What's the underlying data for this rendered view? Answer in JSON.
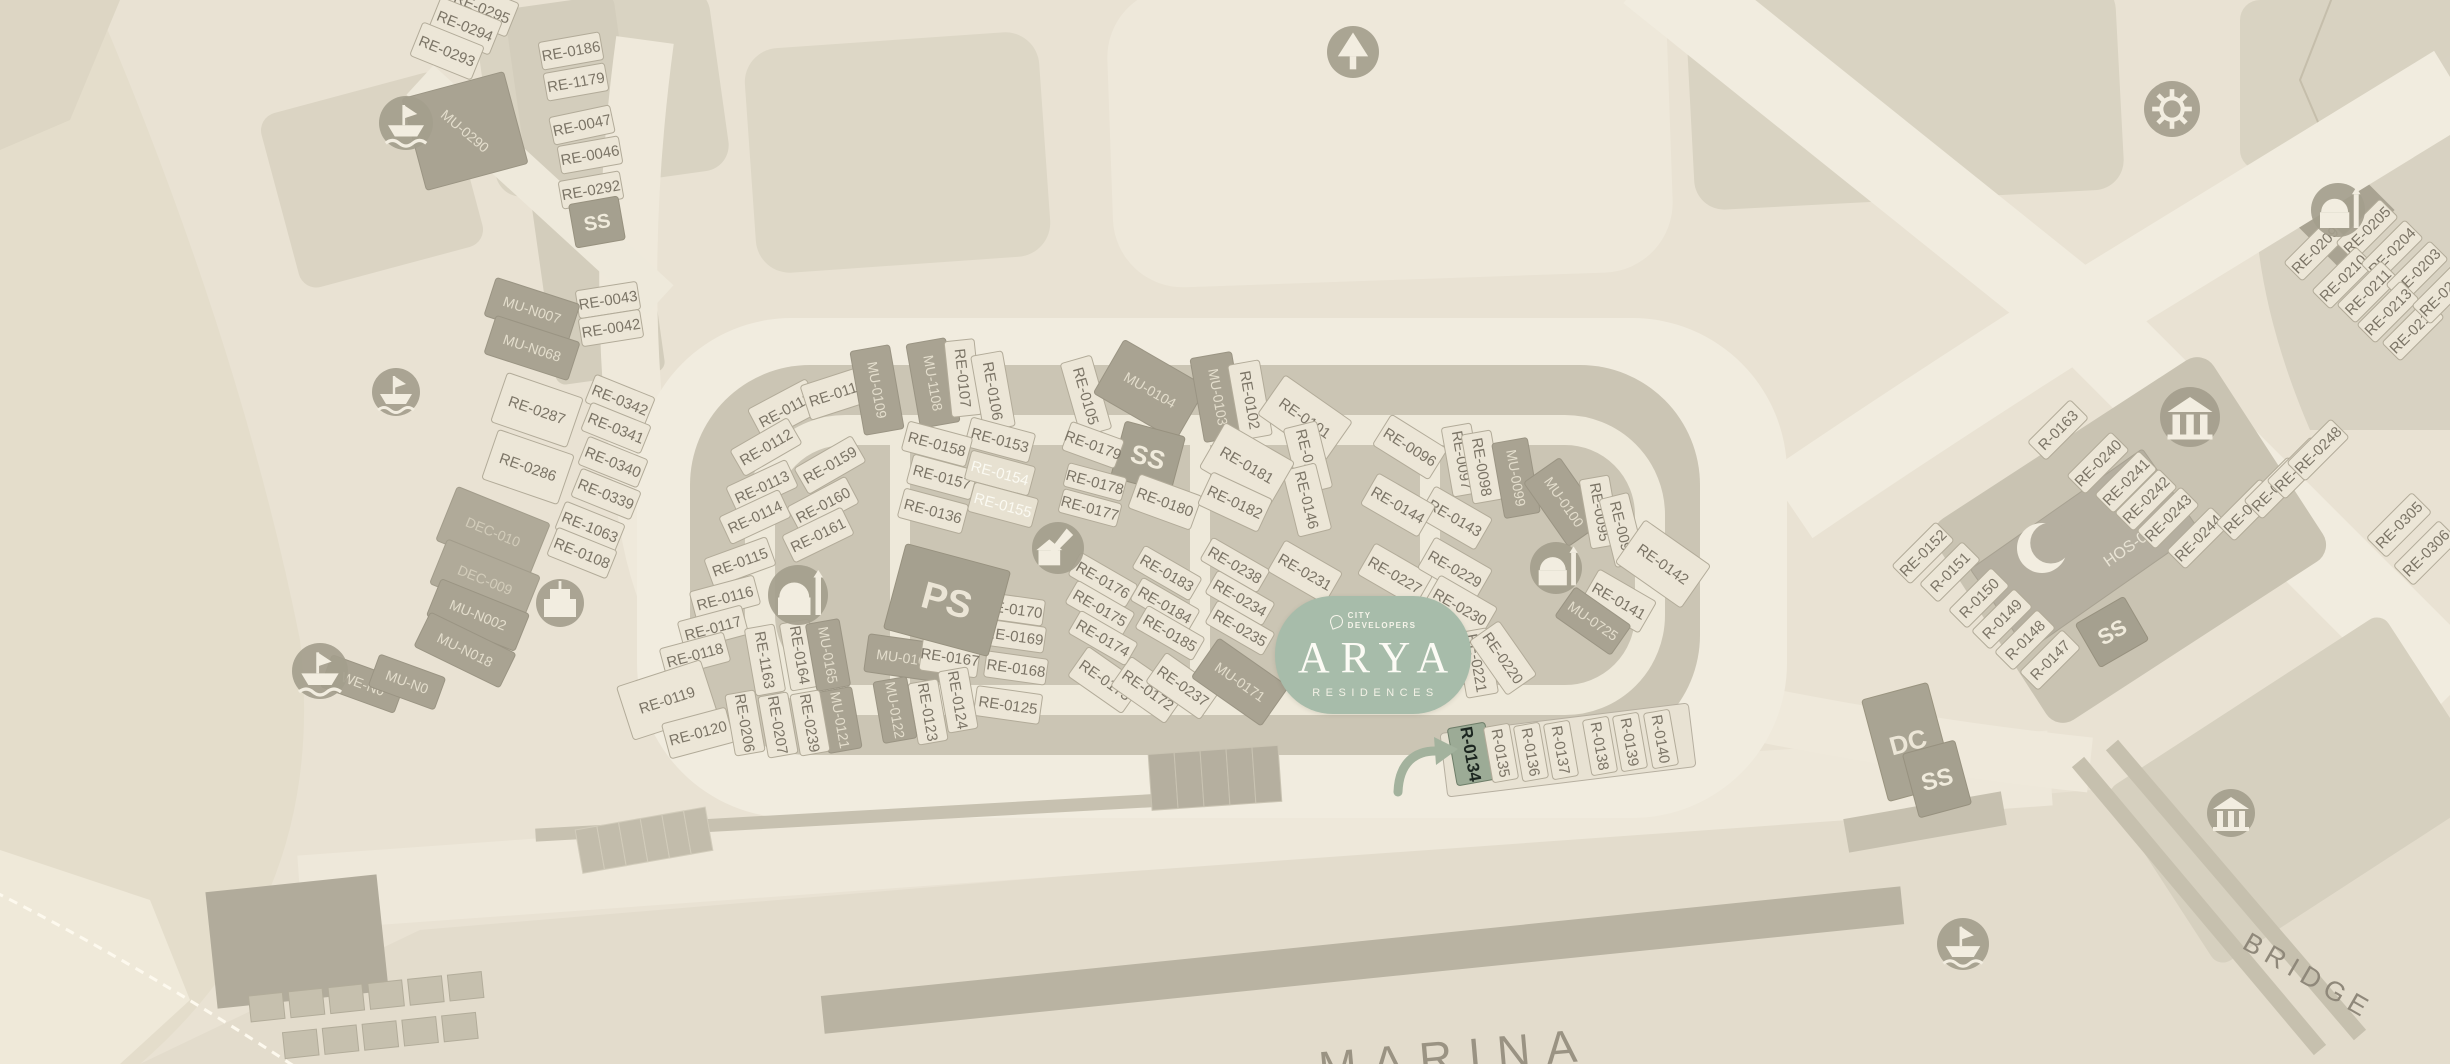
{
  "badge": {
    "developer_line1": "CITY",
    "developer_line2": "DEVELOPERS",
    "name": "ARYA",
    "subtitle": "RESIDENCES"
  },
  "highlighted_plot": "R-0134",
  "palette": {
    "bg": "#e9e2d3",
    "coast": "#e4ddcb",
    "block": "#d9d3c2",
    "cluster_base": "#cbc5b4",
    "road": "#f1ecdf",
    "plot": "#ece6d7",
    "plot_stroke": "#b2ab99",
    "label": "#7b7466",
    "dark_plot": "#a9a392",
    "dark_label": "#e4decd",
    "badge_green": "#a7bcaa",
    "highlight_fill": "#9cab96",
    "highlight_text": "#1c2620",
    "arrow": "#a3b29d",
    "icon_bg": "#a49e8d",
    "icon_glyph": "#f2ede0",
    "quay": "#b9b3a2",
    "marina_text": "#9a9383",
    "bridge_text": "#8f887a"
  },
  "map_texts": [
    {
      "id": "marina-label",
      "label": "MARINA",
      "x": 1457,
      "y": 1072,
      "rot": -5,
      "size": 46,
      "ls": 16,
      "color": "#9a9383"
    },
    {
      "id": "bridge-label",
      "label": "BRIDGE",
      "x": 2304,
      "y": 984,
      "rot": 30,
      "size": 27,
      "ls": 7,
      "color": "#8f887a"
    }
  ],
  "plots": [
    {
      "l": "RE-0295",
      "x": 482,
      "y": 8,
      "r": 22
    },
    {
      "l": "RE-0294",
      "x": 465,
      "y": 26,
      "r": 22
    },
    {
      "l": "RE-0293",
      "x": 447,
      "y": 51,
      "r": 22
    },
    {
      "l": "RE-0186",
      "x": 571,
      "y": 51,
      "r": -10,
      "w": 62,
      "h": 28
    },
    {
      "l": "RE-1179",
      "x": 576,
      "y": 82,
      "r": -10,
      "w": 62,
      "h": 28
    },
    {
      "l": "RE-0047",
      "x": 582,
      "y": 125,
      "r": -12,
      "w": 62,
      "h": 28
    },
    {
      "l": "RE-0046",
      "x": 590,
      "y": 155,
      "r": -10,
      "w": 62,
      "h": 28
    },
    {
      "l": "RE-0292",
      "x": 591,
      "y": 190,
      "r": -10,
      "w": 62,
      "h": 28
    },
    {
      "l": "SS",
      "x": 597,
      "y": 222,
      "r": -10,
      "t": "ss",
      "w": 50,
      "h": 44,
      "fs": 20
    },
    {
      "l": "RE-0043",
      "x": 608,
      "y": 300,
      "r": -9,
      "w": 62,
      "h": 28
    },
    {
      "l": "RE-0042",
      "x": 611,
      "y": 328,
      "r": -9,
      "w": 62,
      "h": 28
    },
    {
      "l": "MU-0290",
      "x": 465,
      "y": 131,
      "r": -15,
      "tr": 40,
      "t": "mu",
      "w": 105,
      "h": 95
    },
    {
      "l": "MU-N007",
      "x": 532,
      "y": 310,
      "r": 18,
      "t": "mu",
      "w": 88,
      "h": 40
    },
    {
      "l": "MU-N068",
      "x": 532,
      "y": 348,
      "r": 18,
      "t": "mu",
      "w": 88,
      "h": 40
    },
    {
      "l": "RE-0287",
      "x": 537,
      "y": 410,
      "r": 19,
      "w": 80,
      "h": 52
    },
    {
      "l": "RE-0286",
      "x": 528,
      "y": 467,
      "r": 19,
      "w": 80,
      "h": 52
    },
    {
      "l": "RE-0342",
      "x": 620,
      "y": 400,
      "r": 22,
      "w": 64,
      "h": 30
    },
    {
      "l": "RE-0341",
      "x": 616,
      "y": 428,
      "r": 22,
      "w": 64,
      "h": 30
    },
    {
      "l": "RE-0340",
      "x": 613,
      "y": 462,
      "r": 22,
      "w": 64,
      "h": 30
    },
    {
      "l": "RE-0339",
      "x": 606,
      "y": 494,
      "r": 22,
      "w": 64,
      "h": 30
    },
    {
      "l": "RE-1063",
      "x": 590,
      "y": 527,
      "r": 22,
      "w": 64,
      "h": 30
    },
    {
      "l": "RE-0108",
      "x": 582,
      "y": 553,
      "r": 22,
      "w": 64,
      "h": 30
    },
    {
      "l": "DEC-010",
      "x": 493,
      "y": 532,
      "r": 22,
      "t": "dec",
      "w": 100,
      "h": 58
    },
    {
      "l": "DEC-009",
      "x": 485,
      "y": 580,
      "r": 22,
      "t": "dec",
      "w": 100,
      "h": 48
    },
    {
      "l": "MU-N002",
      "x": 478,
      "y": 615,
      "r": 22,
      "t": "mu",
      "w": 95,
      "h": 40
    },
    {
      "l": "MU-N018",
      "x": 465,
      "y": 650,
      "r": 26,
      "t": "mu",
      "w": 95,
      "h": 38
    },
    {
      "l": "WE-N0",
      "x": 363,
      "y": 684,
      "r": 20,
      "t": "mu",
      "w": 78,
      "h": 34
    },
    {
      "l": "MU-N0",
      "x": 407,
      "y": 682,
      "r": 20,
      "t": "mu",
      "w": 70,
      "h": 34
    },
    {
      "l": "RE-0111",
      "x": 785,
      "y": 410,
      "r": -28
    },
    {
      "l": "RE-0110",
      "x": 837,
      "y": 393,
      "r": -18
    },
    {
      "l": "MU-0109",
      "x": 877,
      "y": 390,
      "r": 80,
      "t": "mu",
      "w": 85,
      "h": 40
    },
    {
      "l": "MU-1108",
      "x": 933,
      "y": 383,
      "r": 80,
      "t": "mu",
      "w": 85,
      "h": 40
    },
    {
      "l": "RE-0107",
      "x": 963,
      "y": 378,
      "r": 84,
      "w": 76,
      "h": 30
    },
    {
      "l": "RE-0106",
      "x": 993,
      "y": 391,
      "r": 80,
      "w": 76,
      "h": 32
    },
    {
      "l": "RE-0105",
      "x": 1086,
      "y": 396,
      "r": 74,
      "w": 76,
      "h": 32
    },
    {
      "l": "MU-0104",
      "x": 1150,
      "y": 390,
      "r": 30,
      "t": "mu",
      "w": 95,
      "h": 62
    },
    {
      "l": "MU-0103",
      "x": 1218,
      "y": 397,
      "r": 80,
      "t": "mu",
      "w": 85,
      "h": 42
    },
    {
      "l": "RE-0102",
      "x": 1250,
      "y": 400,
      "r": 80,
      "w": 76,
      "h": 32
    },
    {
      "l": "RE-0101",
      "x": 1305,
      "y": 418,
      "r": 35,
      "w": 82,
      "h": 48
    },
    {
      "l": "RE-0096",
      "x": 1410,
      "y": 447,
      "r": 32
    },
    {
      "l": "RE-0097",
      "x": 1462,
      "y": 460,
      "r": 80,
      "w": 70,
      "h": 30
    },
    {
      "l": "RE-0098",
      "x": 1482,
      "y": 467,
      "r": 80,
      "w": 70,
      "h": 30
    },
    {
      "l": "MU-0099",
      "x": 1516,
      "y": 478,
      "r": 80,
      "t": "mu",
      "w": 76,
      "h": 36
    },
    {
      "l": "MU-0100",
      "x": 1564,
      "y": 502,
      "r": 55,
      "t": "mu",
      "w": 78,
      "h": 44
    },
    {
      "l": "RE-0095",
      "x": 1600,
      "y": 512,
      "r": 80,
      "w": 70,
      "h": 30
    },
    {
      "l": "RE-0094",
      "x": 1622,
      "y": 530,
      "r": 76,
      "w": 70,
      "h": 30
    },
    {
      "l": "RE-0142",
      "x": 1663,
      "y": 564,
      "r": 35,
      "w": 80,
      "h": 52
    },
    {
      "l": "RE-0141",
      "x": 1619,
      "y": 601,
      "r": 30
    },
    {
      "l": "MU-0725",
      "x": 1593,
      "y": 621,
      "r": 35,
      "t": "mu",
      "w": 68,
      "h": 36
    },
    {
      "l": "RE-0143",
      "x": 1455,
      "y": 518,
      "r": 30
    },
    {
      "l": "RE-0144",
      "x": 1398,
      "y": 505,
      "r": 30
    },
    {
      "l": "RE-0145",
      "x": 1308,
      "y": 458,
      "r": 76,
      "w": 68,
      "h": 34
    },
    {
      "l": "RE-0146",
      "x": 1307,
      "y": 500,
      "r": 76,
      "w": 68,
      "h": 34
    },
    {
      "l": "RE-0153",
      "x": 1000,
      "y": 440,
      "r": 15,
      "w": 66,
      "h": 30
    },
    {
      "l": "RE-0158",
      "x": 937,
      "y": 444,
      "r": 15,
      "w": 66,
      "h": 30
    },
    {
      "l": "RE-0157",
      "x": 942,
      "y": 477,
      "r": 15,
      "w": 66,
      "h": 30
    },
    {
      "l": "RE-0136",
      "x": 933,
      "y": 511,
      "r": 15,
      "w": 66,
      "h": 30
    },
    {
      "l": "RE-0154",
      "x": 1000,
      "y": 473,
      "r": 15,
      "t": "rew",
      "w": 66,
      "h": 30
    },
    {
      "l": "RE-0155",
      "x": 1003,
      "y": 505,
      "r": 15,
      "t": "rew",
      "w": 66,
      "h": 30
    },
    {
      "l": "SS",
      "x": 1148,
      "y": 457,
      "r": 15,
      "t": "ss",
      "w": 62,
      "h": 58
    },
    {
      "l": "RE-0179",
      "x": 1093,
      "y": 445,
      "r": 20,
      "w": 56,
      "h": 30
    },
    {
      "l": "RE-0178",
      "x": 1095,
      "y": 482,
      "r": 15,
      "w": 60,
      "h": 24
    },
    {
      "l": "RE-0177",
      "x": 1090,
      "y": 508,
      "r": 15,
      "w": 60,
      "h": 24
    },
    {
      "l": "RE-0180",
      "x": 1165,
      "y": 502,
      "r": 20
    },
    {
      "l": "RE-0181",
      "x": 1247,
      "y": 465,
      "r": 30,
      "w": 80,
      "h": 52
    },
    {
      "l": "RE-0182",
      "x": 1235,
      "y": 502,
      "r": 25
    },
    {
      "l": "RE-0159",
      "x": 830,
      "y": 465,
      "r": -30,
      "w": 66,
      "h": 30
    },
    {
      "l": "RE-0160",
      "x": 823,
      "y": 505,
      "r": -28,
      "w": 66,
      "h": 30
    },
    {
      "l": "RE-0161",
      "x": 818,
      "y": 535,
      "r": -26,
      "w": 66,
      "h": 30
    },
    {
      "l": "RE-0112",
      "x": 766,
      "y": 447,
      "r": -30,
      "w": 66,
      "h": 30
    },
    {
      "l": "RE-0113",
      "x": 762,
      "y": 487,
      "r": -25,
      "w": 66,
      "h": 30
    },
    {
      "l": "RE-0114",
      "x": 755,
      "y": 517,
      "r": -25,
      "w": 66,
      "h": 30
    },
    {
      "l": "RE-0115",
      "x": 740,
      "y": 562,
      "r": -20,
      "w": 66,
      "h": 30
    },
    {
      "l": "RE-0116",
      "x": 725,
      "y": 598,
      "r": -15,
      "w": 66,
      "h": 30
    },
    {
      "l": "RE-0117",
      "x": 713,
      "y": 628,
      "r": -15,
      "w": 66,
      "h": 30
    },
    {
      "l": "RE-0118",
      "x": 695,
      "y": 655,
      "r": -15,
      "w": 66,
      "h": 30
    },
    {
      "l": "RE-0119",
      "x": 667,
      "y": 700,
      "r": -18,
      "w": 88,
      "h": 56
    },
    {
      "l": "RE-0120",
      "x": 698,
      "y": 733,
      "r": -15
    },
    {
      "l": "RE-1163",
      "x": 765,
      "y": 660,
      "r": 80,
      "w": 68,
      "h": 30
    },
    {
      "l": "RE-0164",
      "x": 800,
      "y": 655,
      "r": 80,
      "w": 68,
      "h": 30
    },
    {
      "l": "MU-0165",
      "x": 828,
      "y": 655,
      "r": 80,
      "t": "mu",
      "w": 68,
      "h": 34
    },
    {
      "l": "MU-0166",
      "x": 905,
      "y": 658,
      "r": 8,
      "t": "mu",
      "w": 78,
      "h": 38
    },
    {
      "l": "RE-0167",
      "x": 950,
      "y": 657,
      "r": 8,
      "w": 58,
      "h": 34
    },
    {
      "l": "RE-0170",
      "x": 1013,
      "y": 609,
      "r": 8,
      "w": 62,
      "h": 26
    },
    {
      "l": "RE-0169",
      "x": 1014,
      "y": 636,
      "r": 8,
      "w": 62,
      "h": 26
    },
    {
      "l": "RE-0168",
      "x": 1016,
      "y": 668,
      "r": 8,
      "w": 62,
      "h": 26
    },
    {
      "l": "RE-0125",
      "x": 1008,
      "y": 705,
      "r": 8,
      "w": 66,
      "h": 30
    },
    {
      "l": "RE-0124",
      "x": 958,
      "y": 700,
      "r": 80,
      "w": 62,
      "h": 30
    },
    {
      "l": "RE-0123",
      "x": 928,
      "y": 712,
      "r": 80,
      "w": 62,
      "h": 30
    },
    {
      "l": "MU-0122",
      "x": 895,
      "y": 710,
      "r": 80,
      "t": "mu",
      "w": 62,
      "h": 34
    },
    {
      "l": "MU-0121",
      "x": 840,
      "y": 720,
      "r": 80,
      "t": "mu",
      "w": 62,
      "h": 34
    },
    {
      "l": "RE-0239",
      "x": 810,
      "y": 723,
      "r": 80,
      "w": 62,
      "h": 30
    },
    {
      "l": "RE-0207",
      "x": 778,
      "y": 725,
      "r": 80,
      "w": 62,
      "h": 30
    },
    {
      "l": "RE-0206",
      "x": 745,
      "y": 723,
      "r": 80,
      "w": 62,
      "h": 30
    },
    {
      "l": "PS",
      "x": 947,
      "y": 600,
      "r": 15,
      "t": "ps",
      "w": 108,
      "h": 88
    },
    {
      "l": "RE-0173",
      "x": 1105,
      "y": 680,
      "r": 35
    },
    {
      "l": "RE-0172",
      "x": 1148,
      "y": 690,
      "r": 35
    },
    {
      "l": "RE-0237",
      "x": 1183,
      "y": 686,
      "r": 35
    },
    {
      "l": "MU-0171",
      "x": 1240,
      "y": 682,
      "r": 35,
      "t": "mu",
      "w": 85,
      "h": 48
    },
    {
      "l": "RE-0176",
      "x": 1103,
      "y": 580,
      "r": 30,
      "w": 66,
      "h": 26
    },
    {
      "l": "RE-0175",
      "x": 1100,
      "y": 608,
      "r": 30,
      "w": 66,
      "h": 26
    },
    {
      "l": "RE-0174",
      "x": 1103,
      "y": 638,
      "r": 30,
      "w": 66,
      "h": 26
    },
    {
      "l": "RE-0183",
      "x": 1167,
      "y": 573,
      "r": 30,
      "w": 66,
      "h": 26
    },
    {
      "l": "RE-0184",
      "x": 1165,
      "y": 605,
      "r": 30,
      "w": 66,
      "h": 26
    },
    {
      "l": "RE-0185",
      "x": 1170,
      "y": 633,
      "r": 30,
      "w": 66,
      "h": 26
    },
    {
      "l": "RE-0238",
      "x": 1235,
      "y": 565,
      "r": 30,
      "w": 66,
      "h": 26
    },
    {
      "l": "RE-0234",
      "x": 1240,
      "y": 598,
      "r": 30,
      "w": 66,
      "h": 26
    },
    {
      "l": "RE-0235",
      "x": 1240,
      "y": 628,
      "r": 30,
      "w": 66,
      "h": 26
    },
    {
      "l": "RE-0231",
      "x": 1305,
      "y": 572,
      "r": 30
    },
    {
      "l": "RE-0227",
      "x": 1395,
      "y": 575,
      "r": 30
    },
    {
      "l": "RE-0229",
      "x": 1455,
      "y": 569,
      "r": 30
    },
    {
      "l": "RE-0230",
      "x": 1460,
      "y": 607,
      "r": 30
    },
    {
      "l": "RE-0221",
      "x": 1477,
      "y": 663,
      "r": 80,
      "w": 66,
      "h": 32
    },
    {
      "l": "RE-0220",
      "x": 1503,
      "y": 658,
      "r": 55,
      "w": 66,
      "h": 36
    },
    {
      "l": "R-0134",
      "x": 1471,
      "y": 754,
      "r": 80,
      "t": "hl",
      "w": 58,
      "h": 38
    },
    {
      "l": "R-0135",
      "x": 1501,
      "y": 753,
      "r": 80,
      "w": 56,
      "h": 26
    },
    {
      "l": "R-0136",
      "x": 1531,
      "y": 752,
      "r": 80,
      "w": 56,
      "h": 26
    },
    {
      "l": "R-0137",
      "x": 1561,
      "y": 750,
      "r": 80,
      "w": 56,
      "h": 26
    },
    {
      "l": "R-0138",
      "x": 1600,
      "y": 746,
      "r": 80,
      "w": 56,
      "h": 26
    },
    {
      "l": "R-0139",
      "x": 1630,
      "y": 742,
      "r": 80,
      "w": 56,
      "h": 26
    },
    {
      "l": "R-0140",
      "x": 1661,
      "y": 739,
      "r": 80,
      "w": 56,
      "h": 26
    },
    {
      "l": "RE-0209",
      "x": 2315,
      "y": 250,
      "r": -45,
      "w": 62,
      "h": 26
    },
    {
      "l": "RE-0205",
      "x": 2367,
      "y": 230,
      "r": -45,
      "w": 62,
      "h": 26
    },
    {
      "l": "RE-0210",
      "x": 2343,
      "y": 278,
      "r": -45,
      "w": 62,
      "h": 26
    },
    {
      "l": "RE-0204",
      "x": 2392,
      "y": 251,
      "r": -45,
      "w": 62,
      "h": 26
    },
    {
      "l": "RE-0211",
      "x": 2368,
      "y": 292,
      "r": -45,
      "w": 62,
      "h": 26
    },
    {
      "l": "RE-0203",
      "x": 2417,
      "y": 272,
      "r": -45,
      "w": 62,
      "h": 26
    },
    {
      "l": "RE-0213",
      "x": 2388,
      "y": 312,
      "r": -45,
      "w": 62,
      "h": 26
    },
    {
      "l": "RE-0214",
      "x": 2413,
      "y": 330,
      "r": -45,
      "w": 62,
      "h": 26
    },
    {
      "l": "RE-0202",
      "x": 2443,
      "y": 293,
      "r": -45,
      "w": 62,
      "h": 26
    },
    {
      "l": "HOS-02",
      "x": 2085,
      "y": 550,
      "r": -35,
      "t": "hos",
      "w": 210,
      "h": 100,
      "dx": 38,
      "dy": 22
    },
    {
      "l": "SS",
      "x": 2112,
      "y": 632,
      "r": -30,
      "t": "ss",
      "w": 56,
      "h": 50,
      "fs": 22
    },
    {
      "l": "R-0163",
      "x": 2058,
      "y": 430,
      "r": -45,
      "w": 60,
      "h": 26
    },
    {
      "l": "RE-0240",
      "x": 2098,
      "y": 463,
      "r": -45,
      "w": 62,
      "h": 26
    },
    {
      "l": "RE-0241",
      "x": 2126,
      "y": 482,
      "r": -45,
      "w": 62,
      "h": 26
    },
    {
      "l": "RE-0242",
      "x": 2146,
      "y": 500,
      "r": -45,
      "w": 62,
      "h": 26
    },
    {
      "l": "RE-0243",
      "x": 2168,
      "y": 518,
      "r": -45,
      "w": 62,
      "h": 26
    },
    {
      "l": "RE-0244",
      "x": 2198,
      "y": 538,
      "r": -45,
      "w": 62,
      "h": 26
    },
    {
      "l": "RE-0245",
      "x": 2247,
      "y": 510,
      "r": -45,
      "w": 62,
      "h": 26
    },
    {
      "l": "RE-0246",
      "x": 2275,
      "y": 488,
      "r": -45,
      "w": 62,
      "h": 26
    },
    {
      "l": "RE-0247",
      "x": 2298,
      "y": 468,
      "r": -45,
      "w": 62,
      "h": 26
    },
    {
      "l": "RE-0248",
      "x": 2318,
      "y": 450,
      "r": -45,
      "w": 62,
      "h": 26
    },
    {
      "l": "RE-0152",
      "x": 1923,
      "y": 553,
      "r": -45,
      "w": 62,
      "h": 26
    },
    {
      "l": "R-0151",
      "x": 1950,
      "y": 572,
      "r": -45,
      "w": 60,
      "h": 26
    },
    {
      "l": "R-0150",
      "x": 1979,
      "y": 598,
      "r": -45,
      "w": 60,
      "h": 26
    },
    {
      "l": "R-0149",
      "x": 2002,
      "y": 619,
      "r": -45,
      "w": 60,
      "h": 26
    },
    {
      "l": "R-0148",
      "x": 2025,
      "y": 640,
      "r": -45,
      "w": 60,
      "h": 26
    },
    {
      "l": "R-0147",
      "x": 2050,
      "y": 660,
      "r": -45,
      "w": 60,
      "h": 26
    },
    {
      "l": "RE-0305",
      "x": 2399,
      "y": 525,
      "r": -45,
      "w": 64,
      "h": 28
    },
    {
      "l": "RE-0306",
      "x": 2426,
      "y": 553,
      "r": -45,
      "w": 64,
      "h": 28
    },
    {
      "l": "DC",
      "x": 1908,
      "y": 742,
      "r": -15,
      "t": "dc",
      "w": 68,
      "h": 105
    },
    {
      "l": "SS",
      "x": 1937,
      "y": 779,
      "r": -15,
      "t": "ss",
      "w": 54,
      "h": 66,
      "fs": 24
    }
  ],
  "icons": [
    {
      "k": "marina-icon",
      "x": 406,
      "y": 123,
      "s": 27
    },
    {
      "k": "marina-icon",
      "x": 396,
      "y": 392,
      "s": 24
    },
    {
      "k": "marina-icon",
      "x": 320,
      "y": 671,
      "s": 28
    },
    {
      "k": "building-icon",
      "x": 560,
      "y": 603,
      "s": 24
    },
    {
      "k": "park-icon",
      "x": 1353,
      "y": 52,
      "s": 26
    },
    {
      "k": "gear-icon",
      "x": 2172,
      "y": 109,
      "s": 28
    },
    {
      "k": "mosque-icon",
      "x": 798,
      "y": 595,
      "s": 30
    },
    {
      "k": "school-icon",
      "x": 1058,
      "y": 548,
      "s": 26
    },
    {
      "k": "mosque-icon",
      "x": 1556,
      "y": 568,
      "s": 26
    },
    {
      "k": "mosque-icon",
      "x": 2338,
      "y": 210,
      "s": 27
    },
    {
      "k": "institution-icon",
      "x": 2190,
      "y": 417,
      "s": 30
    },
    {
      "k": "institution-icon",
      "x": 2231,
      "y": 813,
      "s": 24
    },
    {
      "k": "marina-icon",
      "x": 1963,
      "y": 944,
      "s": 26
    },
    {
      "k": "crescent-icon",
      "x": 2042,
      "y": 548,
      "s": 30
    }
  ]
}
